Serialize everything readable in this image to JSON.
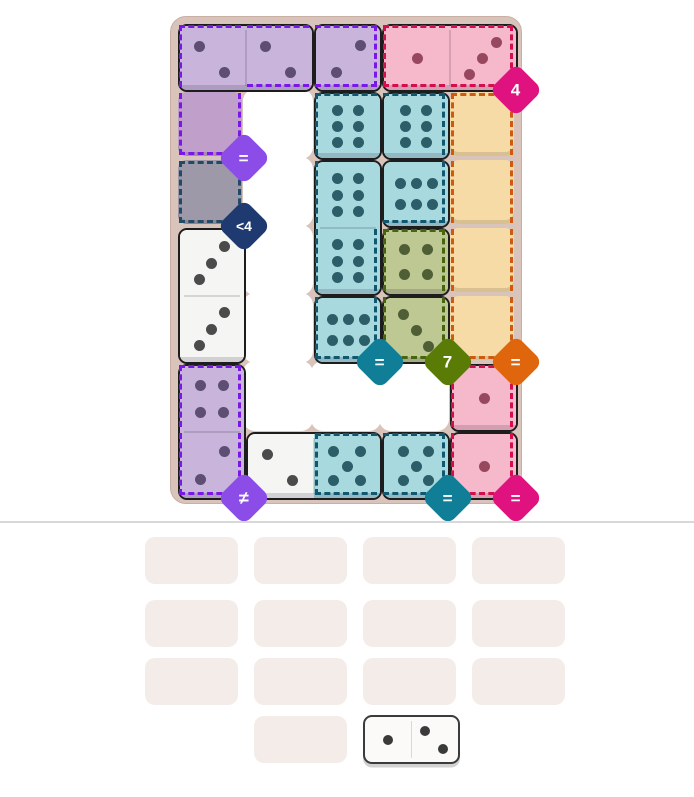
{
  "page": {
    "background": "#ffffff",
    "divider_color": "#d8d8d8"
  },
  "board": {
    "frame_color": "#d9c4bb",
    "frame_border": "#c9afa4",
    "hole_color": "#ffffff",
    "rows": 7,
    "cols": 5,
    "palette": {
      "purple": {
        "fill": "#c9b5dc",
        "dot": "#5e4e74"
      },
      "pink": {
        "fill": "#f5b9cb",
        "dot": "#97485f"
      },
      "teal": {
        "fill": "#a7d9df",
        "dot": "#2c5e69"
      },
      "olive": {
        "fill": "#bdc893",
        "dot": "#4f5e35"
      },
      "white": {
        "fill": "#f5f5f3",
        "dot": "#4b4b4b"
      }
    },
    "holes": [
      [
        1,
        1
      ],
      [
        2,
        1
      ],
      [
        3,
        1
      ],
      [
        4,
        1
      ],
      [
        5,
        1
      ],
      [
        5,
        2
      ],
      [
        5,
        3
      ]
    ],
    "empty_cells": [
      {
        "r": 1,
        "c": 0,
        "fill": "#c0a0ca",
        "name": "empty-cell-purple"
      },
      {
        "r": 2,
        "c": 0,
        "fill": "#9e99a8",
        "name": "empty-cell-gray"
      },
      {
        "r": 1,
        "c": 4,
        "fill": "#f7dba6",
        "name": "empty-cell-tan"
      },
      {
        "r": 2,
        "c": 4,
        "fill": "#f7dba6",
        "name": "empty-cell-tan"
      },
      {
        "r": 3,
        "c": 4,
        "fill": "#f7dba6",
        "name": "empty-cell-tan"
      },
      {
        "r": 4,
        "c": 4,
        "fill": "#f7dba6",
        "name": "empty-cell-tan"
      }
    ],
    "tiles": [
      {
        "halves": [
          {
            "r": 0,
            "c": 0,
            "color": "purple",
            "pips": 2,
            "layout": "2a"
          },
          {
            "r": 0,
            "c": 1,
            "color": "purple",
            "pips": 2,
            "layout": "2a"
          }
        ]
      },
      {
        "halves": [
          {
            "r": 0,
            "c": 2,
            "color": "purple",
            "pips": 2,
            "layout": "2b"
          }
        ]
      },
      {
        "halves": [
          {
            "r": 0,
            "c": 3,
            "color": "pink",
            "pips": 1,
            "layout": "1"
          },
          {
            "r": 0,
            "c": 4,
            "color": "pink",
            "pips": 3,
            "layout": "3a"
          }
        ]
      },
      {
        "halves": [
          {
            "r": 1,
            "c": 2,
            "color": "teal",
            "pips": 6,
            "layout": "6v"
          }
        ]
      },
      {
        "halves": [
          {
            "r": 1,
            "c": 3,
            "color": "teal",
            "pips": 6,
            "layout": "6v"
          }
        ]
      },
      {
        "halves": [
          {
            "r": 2,
            "c": 2,
            "color": "teal",
            "pips": 6,
            "layout": "6v"
          },
          {
            "r": 3,
            "c": 2,
            "color": "teal",
            "pips": 6,
            "layout": "6v"
          }
        ]
      },
      {
        "halves": [
          {
            "r": 2,
            "c": 3,
            "color": "teal",
            "pips": 6,
            "layout": "6h"
          }
        ]
      },
      {
        "halves": [
          {
            "r": 3,
            "c": 3,
            "color": "olive",
            "pips": 4,
            "layout": "4"
          }
        ]
      },
      {
        "halves": [
          {
            "r": 4,
            "c": 2,
            "color": "teal",
            "pips": 6,
            "layout": "6h"
          }
        ]
      },
      {
        "halves": [
          {
            "r": 4,
            "c": 3,
            "color": "olive",
            "pips": 3,
            "layout": "3b"
          }
        ]
      },
      {
        "halves": [
          {
            "r": 3,
            "c": 0,
            "color": "white",
            "pips": 3,
            "layout": "3a"
          },
          {
            "r": 4,
            "c": 0,
            "color": "white",
            "pips": 3,
            "layout": "3a"
          }
        ]
      },
      {
        "halves": [
          {
            "r": 5,
            "c": 0,
            "color": "purple",
            "pips": 4,
            "layout": "4"
          },
          {
            "r": 6,
            "c": 0,
            "color": "purple",
            "pips": 2,
            "layout": "2b"
          }
        ]
      },
      {
        "halves": [
          {
            "r": 6,
            "c": 1,
            "color": "white",
            "pips": 2,
            "layout": "2a"
          },
          {
            "r": 6,
            "c": 2,
            "color": "teal",
            "pips": 5,
            "layout": "5"
          }
        ]
      },
      {
        "halves": [
          {
            "r": 6,
            "c": 3,
            "color": "teal",
            "pips": 5,
            "layout": "5"
          }
        ]
      },
      {
        "halves": [
          {
            "r": 5,
            "c": 4,
            "color": "pink",
            "pips": 1,
            "layout": "1"
          }
        ]
      },
      {
        "halves": [
          {
            "r": 6,
            "c": 4,
            "color": "pink",
            "pips": 1,
            "layout": "1"
          }
        ]
      }
    ],
    "regions": [
      {
        "name": "purple-top",
        "border_color": "#7a16e8",
        "cells": [
          [
            0,
            0
          ],
          [
            0,
            1
          ],
          [
            0,
            2
          ],
          [
            1,
            0
          ]
        ],
        "badge": {
          "label": "=",
          "color": "#8b4ce8",
          "corner": [
            1,
            0
          ]
        }
      },
      {
        "name": "navy",
        "border_color": "#224a66",
        "cells": [
          [
            2,
            0
          ]
        ],
        "badge": {
          "label": "<4",
          "color": "#1e3a70",
          "corner": [
            2,
            0
          ]
        }
      },
      {
        "name": "pink-top",
        "border_color": "#d50d4d",
        "cells": [
          [
            0,
            3
          ],
          [
            0,
            4
          ]
        ],
        "badge": {
          "label": "4",
          "color": "#e01280",
          "corner": [
            0,
            4
          ]
        }
      },
      {
        "name": "teal-main",
        "border_color": "#10586f",
        "cells": [
          [
            1,
            2
          ],
          [
            1,
            3
          ],
          [
            2,
            2
          ],
          [
            2,
            3
          ],
          [
            3,
            2
          ],
          [
            4,
            2
          ]
        ],
        "badge": {
          "label": "=",
          "color": "#0f7e96",
          "corner": [
            4,
            2
          ]
        }
      },
      {
        "name": "olive",
        "border_color": "#47650a",
        "cells": [
          [
            3,
            3
          ],
          [
            4,
            3
          ]
        ],
        "badge": {
          "label": "7",
          "color": "#5b7b07",
          "corner": [
            4,
            3
          ]
        }
      },
      {
        "name": "orange",
        "border_color": "#cd5a0f",
        "cells": [
          [
            1,
            4
          ],
          [
            2,
            4
          ],
          [
            3,
            4
          ],
          [
            4,
            4
          ]
        ],
        "badge": {
          "label": "=",
          "color": "#e0660e",
          "corner": [
            4,
            4
          ]
        }
      },
      {
        "name": "purple-bottom",
        "border_color": "#7a16e8",
        "cells": [
          [
            5,
            0
          ],
          [
            6,
            0
          ]
        ],
        "badge": {
          "label": "≠",
          "color": "#8b4ce8",
          "corner": [
            6,
            0
          ]
        }
      },
      {
        "name": "teal-bottom",
        "border_color": "#10586f",
        "cells": [
          [
            6,
            2
          ],
          [
            6,
            3
          ]
        ],
        "badge": {
          "label": "=",
          "color": "#0f7e96",
          "corner": [
            6,
            3
          ]
        }
      },
      {
        "name": "pink-right",
        "border_color": "#d50d4d",
        "cells": [
          [
            5,
            4
          ],
          [
            6,
            4
          ]
        ],
        "badge": {
          "label": "=",
          "color": "#e01280",
          "corner": [
            6,
            4
          ]
        }
      }
    ]
  },
  "tray": {
    "slot_color": "#f4ece9",
    "slots": [
      [
        0,
        0
      ],
      [
        0,
        1
      ],
      [
        0,
        2
      ],
      [
        0,
        3
      ],
      [
        1,
        0
      ],
      [
        1,
        1
      ],
      [
        1,
        2
      ],
      [
        1,
        3
      ],
      [
        2,
        0
      ],
      [
        2,
        1
      ],
      [
        2,
        2
      ],
      [
        2,
        3
      ],
      [
        3,
        1
      ]
    ],
    "domino": {
      "row": 3,
      "col": 2,
      "fill": "#fbfaf8",
      "border": "#3b3b3b",
      "dot": "#3a3a3a",
      "halves": [
        {
          "pips": 1,
          "layout": "1"
        },
        {
          "pips": 2,
          "layout": "2a"
        }
      ]
    }
  }
}
